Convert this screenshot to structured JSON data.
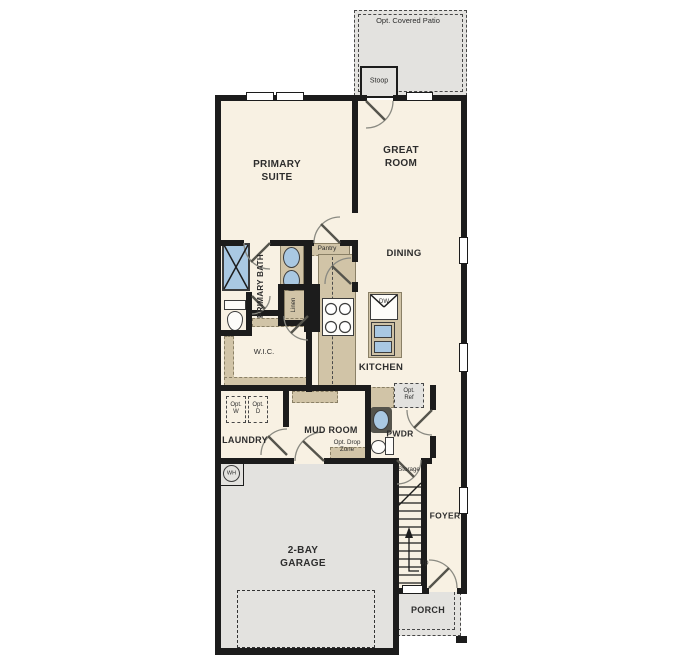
{
  "plan_title": "First floor plan",
  "labels": {
    "opt_covered_patio": "Opt. Covered Patio",
    "stoop": "Stoop",
    "primary_suite": "PRIMARY\nSUITE",
    "great_room": "GREAT\nROOM",
    "dining": "DINING",
    "kitchen": "KITCHEN",
    "primary_bath": "PRIMARY BATH",
    "pantry": "Pantry",
    "linen": "Linen",
    "wic": "W.I.C.",
    "laundry": "LAUNDRY",
    "opt_w": "Opt.\nW",
    "opt_d": "Opt.\nD",
    "mud_room": "MUD ROOM",
    "opt_drop_zone": "Opt. Drop\nZone",
    "pwdr": "PWDR",
    "opt_ref": "Opt.\nRef",
    "storage": "Storage",
    "foyer": "FOYER",
    "up": "Up",
    "garage": "2-BAY\nGARAGE",
    "porch": "PORCH",
    "wh": "WH",
    "dw": "DW"
  },
  "colors": {
    "floor": "#f8f1e3",
    "hardscape": "#e3e2df",
    "counter_tan": "#d1c4a7",
    "fixture_blue": "#a9c8e2",
    "wall": "#1c1c1c"
  }
}
